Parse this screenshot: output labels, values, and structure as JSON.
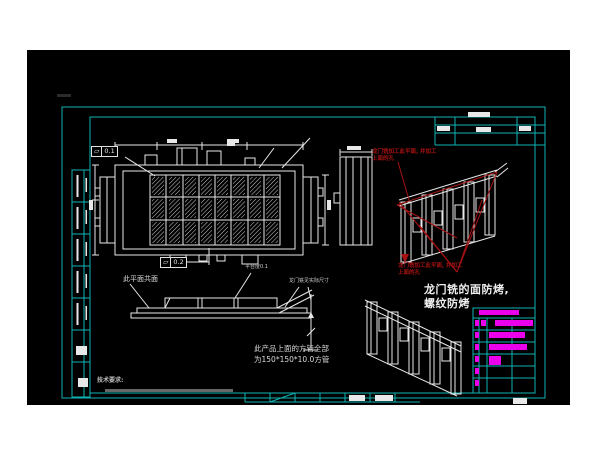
{
  "colors": {
    "canvas_bg": "#000000",
    "frame_cyan": "#0fb3b3",
    "line_white": "#e8e8e8",
    "annotation_red": "#a81212",
    "highlight_magenta": "#ea00ea",
    "page_bg": "#ffffff"
  },
  "tolerances": {
    "frame1": {
      "symbol": "▱",
      "value": "0.1"
    },
    "frame2": {
      "symbol": "▱",
      "value": "0.2"
    }
  },
  "annotations": {
    "red_note_top": "龙门铣加工此平面, 并加工\n上面的孔",
    "red_note_bottom": "龙门铣加工此平面, 并加工\n上面的孔",
    "main_note": "龙门铣的面防烤,\n螺纹防烤",
    "coplanar_note": "此平面共面",
    "platform_note": "平台度0.1",
    "actual_size_note": "龙门铣见实际尺寸",
    "tube_note": "此产品上面的方管全部\n为150*150*10.0方管",
    "tech_req_title": "技术要求:"
  },
  "views": {
    "top_view": "weldment-top-view",
    "side_view": "weldment-side-view",
    "front_view": "weldment-front-elevation",
    "iso_red": "isometric-view-with-red-machining-callouts",
    "iso_plain": "isometric-view-lower"
  }
}
